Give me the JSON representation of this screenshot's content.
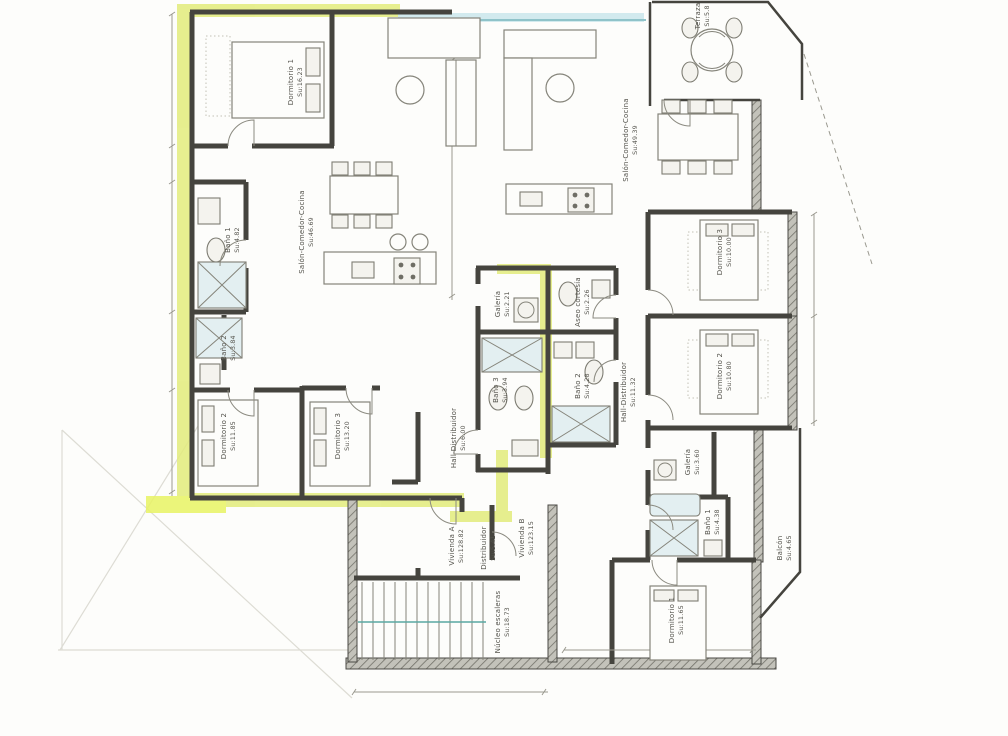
{
  "palette": {
    "paper": "#fdfdfb",
    "ink": "#45443e",
    "label": "#54534c",
    "highlight_yellow": "#e3ec7c",
    "highlight_bright": "#e9f464",
    "glass_cyan": "#cde8ec",
    "stair_teal": "#5aa8a1"
  },
  "plan": {
    "viviendas": {
      "a": {
        "name": "Vivienda A",
        "area": "Su:128.82",
        "rooms": [
          {
            "label": "Dormitorio 1",
            "area": "Su:16.23"
          },
          {
            "label": "Salón-Comedor-Cocina",
            "area": "Su:46.69"
          },
          {
            "label": "Baño 1",
            "area": "Su:4.82"
          },
          {
            "label": "Baño 2",
            "area": "Su:3.84"
          },
          {
            "label": "Dormitorio 2",
            "area": "Su:11.85"
          },
          {
            "label": "Dormitorio 3",
            "area": "Su:13.20"
          },
          {
            "label": "Hall-Distribuidor",
            "area": "Su:6.00"
          },
          {
            "label": "Galería",
            "area": "Su:2.21"
          },
          {
            "label": "Baño 3",
            "area": "Su:3.94"
          }
        ]
      },
      "b": {
        "name": "Vivienda B",
        "area": "Su:123.15",
        "rooms": [
          {
            "label": "Salón-Comedor-Cocina",
            "area": "Su:49.39"
          },
          {
            "label": "Terraza",
            "area": "Su:5.8"
          },
          {
            "label": "Aseo cortesía",
            "area": "Su:2.26"
          },
          {
            "label": "Dormitorio 3",
            "area": "Su:10.00"
          },
          {
            "label": "Baño 2",
            "area": "Su:4.28"
          },
          {
            "label": "Hall-Distribuidor",
            "area": "Su:11.32"
          },
          {
            "label": "Dormitorio 2",
            "area": "Su:10.80"
          },
          {
            "label": "Galería",
            "area": "Su:3.60"
          },
          {
            "label": "Baño 1",
            "area": "Su:4.38"
          },
          {
            "label": "Dormitorio 1",
            "area": "Su:11.65"
          },
          {
            "label": "Balcón",
            "area": "Su:4.65"
          }
        ]
      }
    },
    "common": {
      "distribuidor": {
        "label": "Distribuidor",
        "area": "Su:5.41"
      },
      "nucleo_escaleras": {
        "label": "Núcleo escaleras",
        "area": "Su:18.73"
      }
    }
  }
}
